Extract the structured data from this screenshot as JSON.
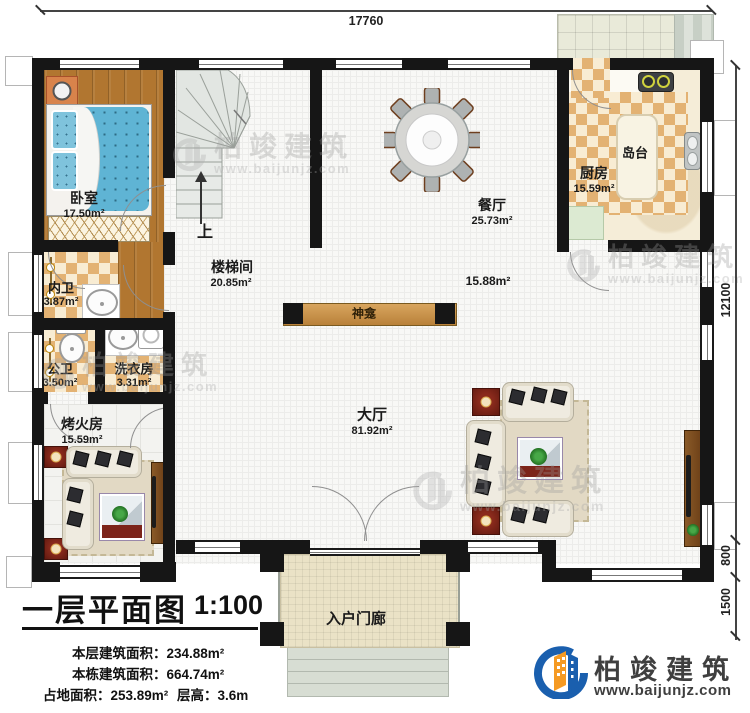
{
  "plan": {
    "title": "一层平面图",
    "scale": "1:100",
    "stat1_label": "本层建筑面积：",
    "stat1_value": "234.88m²",
    "stat2_label": "本栋建筑面积：",
    "stat2_value": "664.74m²",
    "stat3_label": "占地面积：",
    "stat3_value": "253.89m²",
    "stat4_label": "层高：",
    "stat4_value": "3.6m"
  },
  "rooms": {
    "bedroom": {
      "name": "卧室",
      "area": "17.50m²"
    },
    "stairwell": {
      "name": "楼梯间",
      "area": "20.85m²"
    },
    "stairs_up": "上",
    "dining": {
      "name": "餐厅",
      "area": "25.73m²"
    },
    "kitchen": {
      "name": "厨房",
      "area": "15.59m²"
    },
    "island": {
      "name": "岛台"
    },
    "inner_bath": {
      "name": "内卫",
      "area": "3.87m²"
    },
    "public_bath": {
      "name": "公卫",
      "area": "3.50m²"
    },
    "laundry": {
      "name": "洗衣房",
      "area": "3.31m²"
    },
    "fire_room": {
      "name": "烤火房",
      "area": "15.59m²"
    },
    "hall": {
      "name": "大厅",
      "area": "81.92m²"
    },
    "foyer_area": {
      "area": "15.88m²"
    },
    "shrine": {
      "name": "神龛"
    },
    "porch": {
      "name": "入户门廊"
    }
  },
  "dimensions": {
    "top": "17760",
    "right_height": "12100",
    "right_offset": "800",
    "right_porch": "1500"
  },
  "branding": {
    "company": "柏竣建筑",
    "website": "www.baijunjz.com"
  },
  "watermark": {
    "text": "柏竣建筑",
    "url": "www.baijunjz.com"
  },
  "colors": {
    "wall": "#161616",
    "wood": "#b17630",
    "checker_dark": "#e3b273",
    "logo_blue": "#1a5fae",
    "logo_orange": "#f59a23",
    "bed_blue": "#5fb4d4"
  }
}
